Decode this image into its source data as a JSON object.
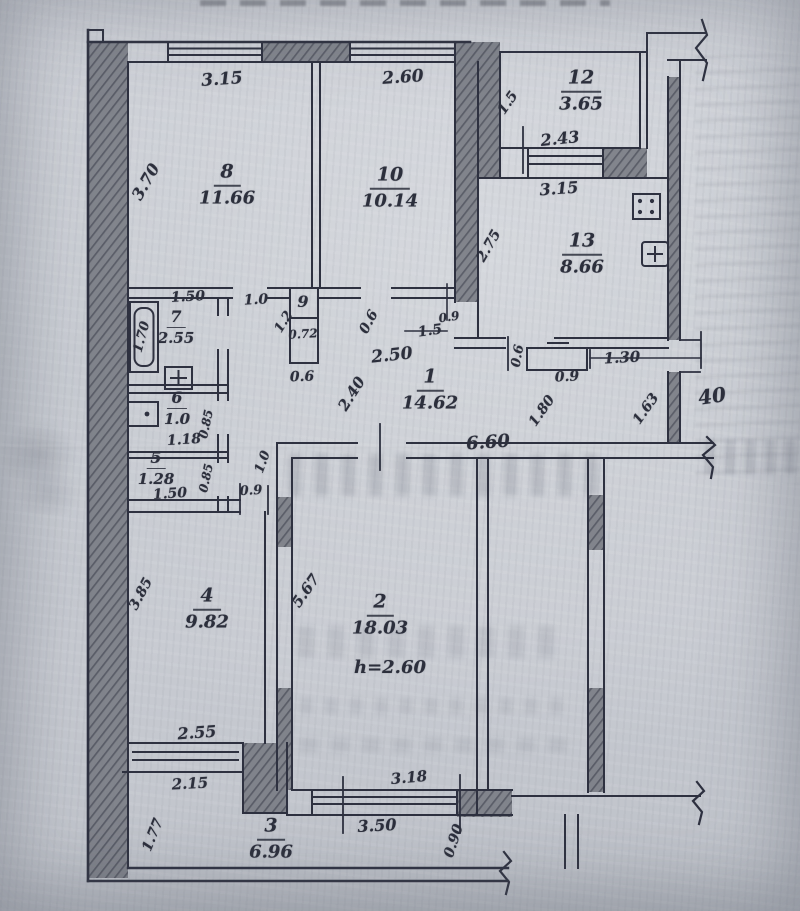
{
  "document": {
    "kind": "scanned handwritten apartment floor plan"
  },
  "rooms": {
    "r1": {
      "number": "1",
      "area": "14.62"
    },
    "r2": {
      "number": "2",
      "area": "18.03",
      "height_note": "h=2.60"
    },
    "r3": {
      "number": "3",
      "area": "6.96"
    },
    "r4": {
      "number": "4",
      "area": "9.82"
    },
    "r5": {
      "number": "5",
      "area": "1.28"
    },
    "r6": {
      "number": "6",
      "area": "1.0"
    },
    "r7": {
      "number": "7",
      "area": "2.55"
    },
    "r8": {
      "number": "8",
      "area": "11.66"
    },
    "r9": {
      "number": "9"
    },
    "r10": {
      "number": "10",
      "area": "10.14"
    },
    "r12": {
      "number": "12",
      "area": "3.65"
    },
    "r13": {
      "number": "13",
      "area": "8.66"
    }
  },
  "dims": {
    "top_room8": "3.15",
    "top_room10": "2.60",
    "left_room8": "3.70",
    "room12_depth": "1.5",
    "room12_width": "2.43",
    "kitchen_width": "3.15",
    "kitchen_depth": "2.75",
    "room7_width": "1.50",
    "room8_door": "1.0",
    "room7_height": "1.70",
    "room9_depth": "1.2",
    "room9_width": "0.72",
    "room9_bottom": "0.6",
    "hall_door_06": "0.6",
    "hall_door_09": "0.9",
    "hall_door_15": "1.5",
    "hall_width": "2.50",
    "hall_depth": "2.40",
    "hall_length": "6.60",
    "room6_width": "1.18",
    "room6_depth": "0.85",
    "room5_width": "1.50",
    "room5_depth": "0.85",
    "hall_10": "1.0",
    "room4_door": "0.9",
    "cabinet_depth": "0.6",
    "cabinet_width": "0.9",
    "wall_130": "1.30",
    "entry_180": "1.80",
    "entry_163": "1.63",
    "wall_40": "40",
    "room4_height": "3.85",
    "room4_width": "2.55",
    "room4_window": "2.15",
    "room2_height": "5.67",
    "room2_window": "3.18",
    "room2_window_outer": "3.50",
    "balcony_depth": "0.90",
    "room3_depth": "1.77"
  }
}
